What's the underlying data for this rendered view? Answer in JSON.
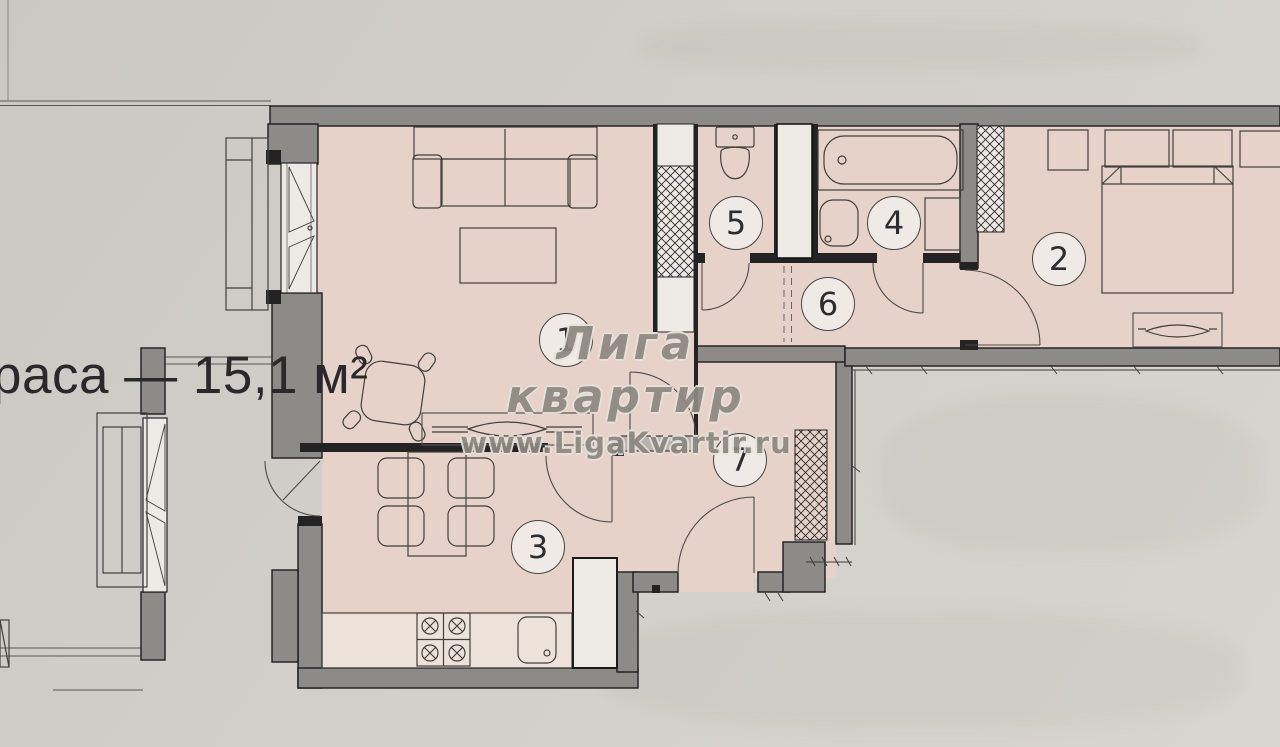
{
  "plan": {
    "watermark": {
      "brand": "Лига квартир",
      "site": "www.LigaKvartir.ru"
    },
    "terrace_label": "раса — 15,1 м²",
    "rooms": [
      {
        "number": "1"
      },
      {
        "number": "2"
      },
      {
        "number": "3"
      },
      {
        "number": "4"
      },
      {
        "number": "5"
      },
      {
        "number": "6"
      },
      {
        "number": "7"
      }
    ],
    "colors": {
      "paper": "#d0cdc8",
      "room": "#e6d2c9",
      "wall": "#8d8b87",
      "line": "#232323",
      "shaft": "#edeae5",
      "watermark": "#8d8881",
      "label": "#29292b"
    }
  },
  "icons": {
    "sofa-icon": "rect-outline-with-arms",
    "coffee-table-icon": "rect-outline",
    "lounge-table-icon": "rounded-square-with-stubs",
    "dining-table-icon": "rect-outline",
    "chair-icon": "rounded-square",
    "stove-icon": "four-burners-circled-x",
    "kitchen-sink-icon": "rounded-rect-with-dot",
    "fridge-cabinet-icon": "white-rect",
    "bathtub-icon": "rounded-rect-with-drain",
    "washbasin-icon": "rounded-rect-with-faucet-dot",
    "toilet-icon": "tank-and-bowl",
    "washing-machine-icon": "square",
    "double-bed-icon": "rect-with-pillow-notches",
    "nightstand-icon": "square",
    "radiator-icon": "winged-lens",
    "vent-shaft-icon": "crosshatched-strip",
    "closet-icon": "crosshatched-strip",
    "window-icon": "casement-triangles",
    "door-icon": "quarter-arc-with-leaf",
    "sliding-partition-icon": "double-dashed-line"
  }
}
